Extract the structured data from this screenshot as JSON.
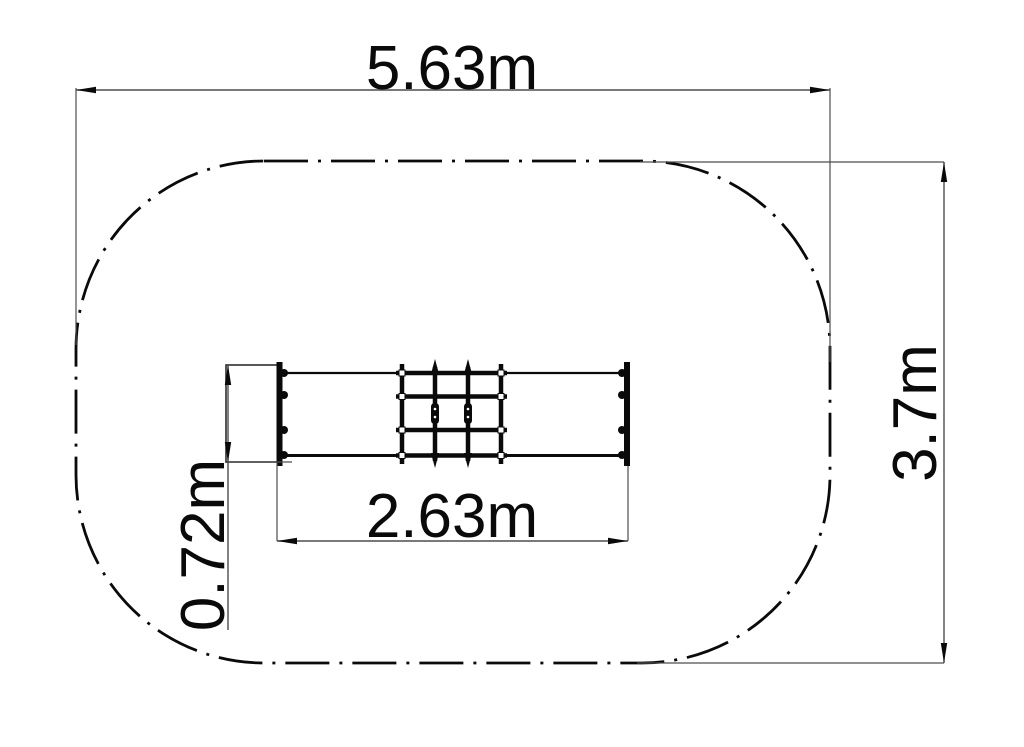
{
  "drawing": {
    "kind": "playground-equipment-plan-view",
    "safety_zone": {
      "width_label": "5.63m",
      "height_label": "3.7m"
    },
    "equipment": {
      "length_label": "2.63m",
      "depth_label": "0.72m"
    }
  },
  "colors": {
    "line": "#0a0a0a",
    "dimension": "#4d4d4d",
    "background": "#ffffff"
  }
}
